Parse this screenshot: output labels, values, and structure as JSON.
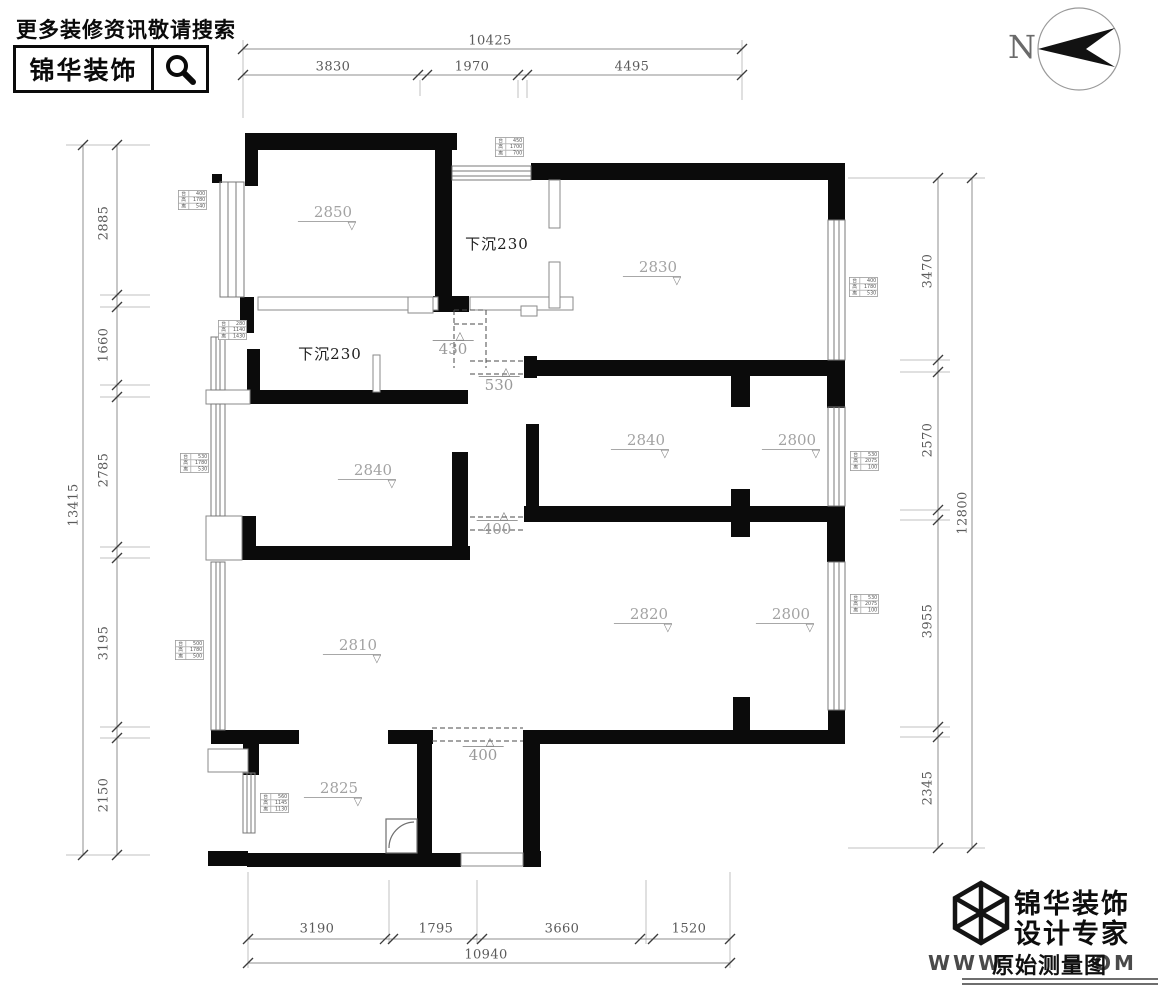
{
  "header": {
    "promo": "更多装修资讯敬请搜索",
    "brand": "锦华装饰"
  },
  "north": {
    "label": "N"
  },
  "icons": {
    "tri_down": "▽",
    "tri_up": "△"
  },
  "dims": {
    "top": {
      "total": "10425",
      "segments": [
        "3830",
        "1970",
        "4495"
      ]
    },
    "left": {
      "total": "13415",
      "segments": [
        "2885",
        "1660",
        "2785",
        "3195",
        "2150"
      ]
    },
    "right": {
      "total": "12800",
      "segments": [
        "3470",
        "2570",
        "3955",
        "2345"
      ]
    },
    "bottom": {
      "total": "10940",
      "segments": [
        "3190",
        "1795",
        "3660",
        "1520"
      ]
    }
  },
  "heights": {
    "h2850": "2850",
    "h2830": "2830",
    "h2840a": "2840",
    "h2840b": "2840",
    "h2800a": "2800",
    "h2810": "2810",
    "h2820": "2820",
    "h2800b": "2800",
    "h2825": "2825"
  },
  "beams": {
    "b430": "430",
    "b530": "530",
    "b400a": "400",
    "b400b": "400"
  },
  "sunken": {
    "s1": "下沉230",
    "s2": "下沉230"
  },
  "window_tags": {
    "t1": {
      "rows": [
        [
          "台",
          "450"
        ],
        [
          "高",
          "1700"
        ],
        [
          "离",
          "700"
        ]
      ]
    },
    "t2": {
      "rows": [
        [
          "台",
          "400"
        ],
        [
          "高",
          "1780"
        ],
        [
          "离",
          "540"
        ]
      ]
    },
    "t3": {
      "rows": [
        [
          "台",
          "280"
        ],
        [
          "高",
          "1140"
        ],
        [
          "离",
          "1430"
        ]
      ]
    },
    "t4": {
      "rows": [
        [
          "台",
          "530"
        ],
        [
          "高",
          "1780"
        ],
        [
          "离",
          "530"
        ]
      ]
    },
    "t5": {
      "rows": [
        [
          "台",
          "500"
        ],
        [
          "高",
          "1780"
        ],
        [
          "离",
          "500"
        ]
      ]
    },
    "t6": {
      "rows": [
        [
          "台",
          "400"
        ],
        [
          "高",
          "1780"
        ],
        [
          "离",
          "530"
        ]
      ]
    },
    "t7": {
      "rows": [
        [
          "台",
          "530"
        ],
        [
          "高",
          "2075"
        ],
        [
          "离",
          "100"
        ]
      ]
    },
    "t8": {
      "rows": [
        [
          "台",
          "530"
        ],
        [
          "高",
          "2075"
        ],
        [
          "离",
          "100"
        ]
      ]
    },
    "t9": {
      "rows": [
        [
          "台",
          "560"
        ],
        [
          "高",
          "1145"
        ],
        [
          "离",
          "1130"
        ]
      ]
    }
  },
  "footer": {
    "brand_line1": "锦华装饰",
    "brand_line2": "设计专家",
    "url_prefix": "WWW",
    "url_suffix": "OM",
    "watermark": "原始测量图"
  }
}
